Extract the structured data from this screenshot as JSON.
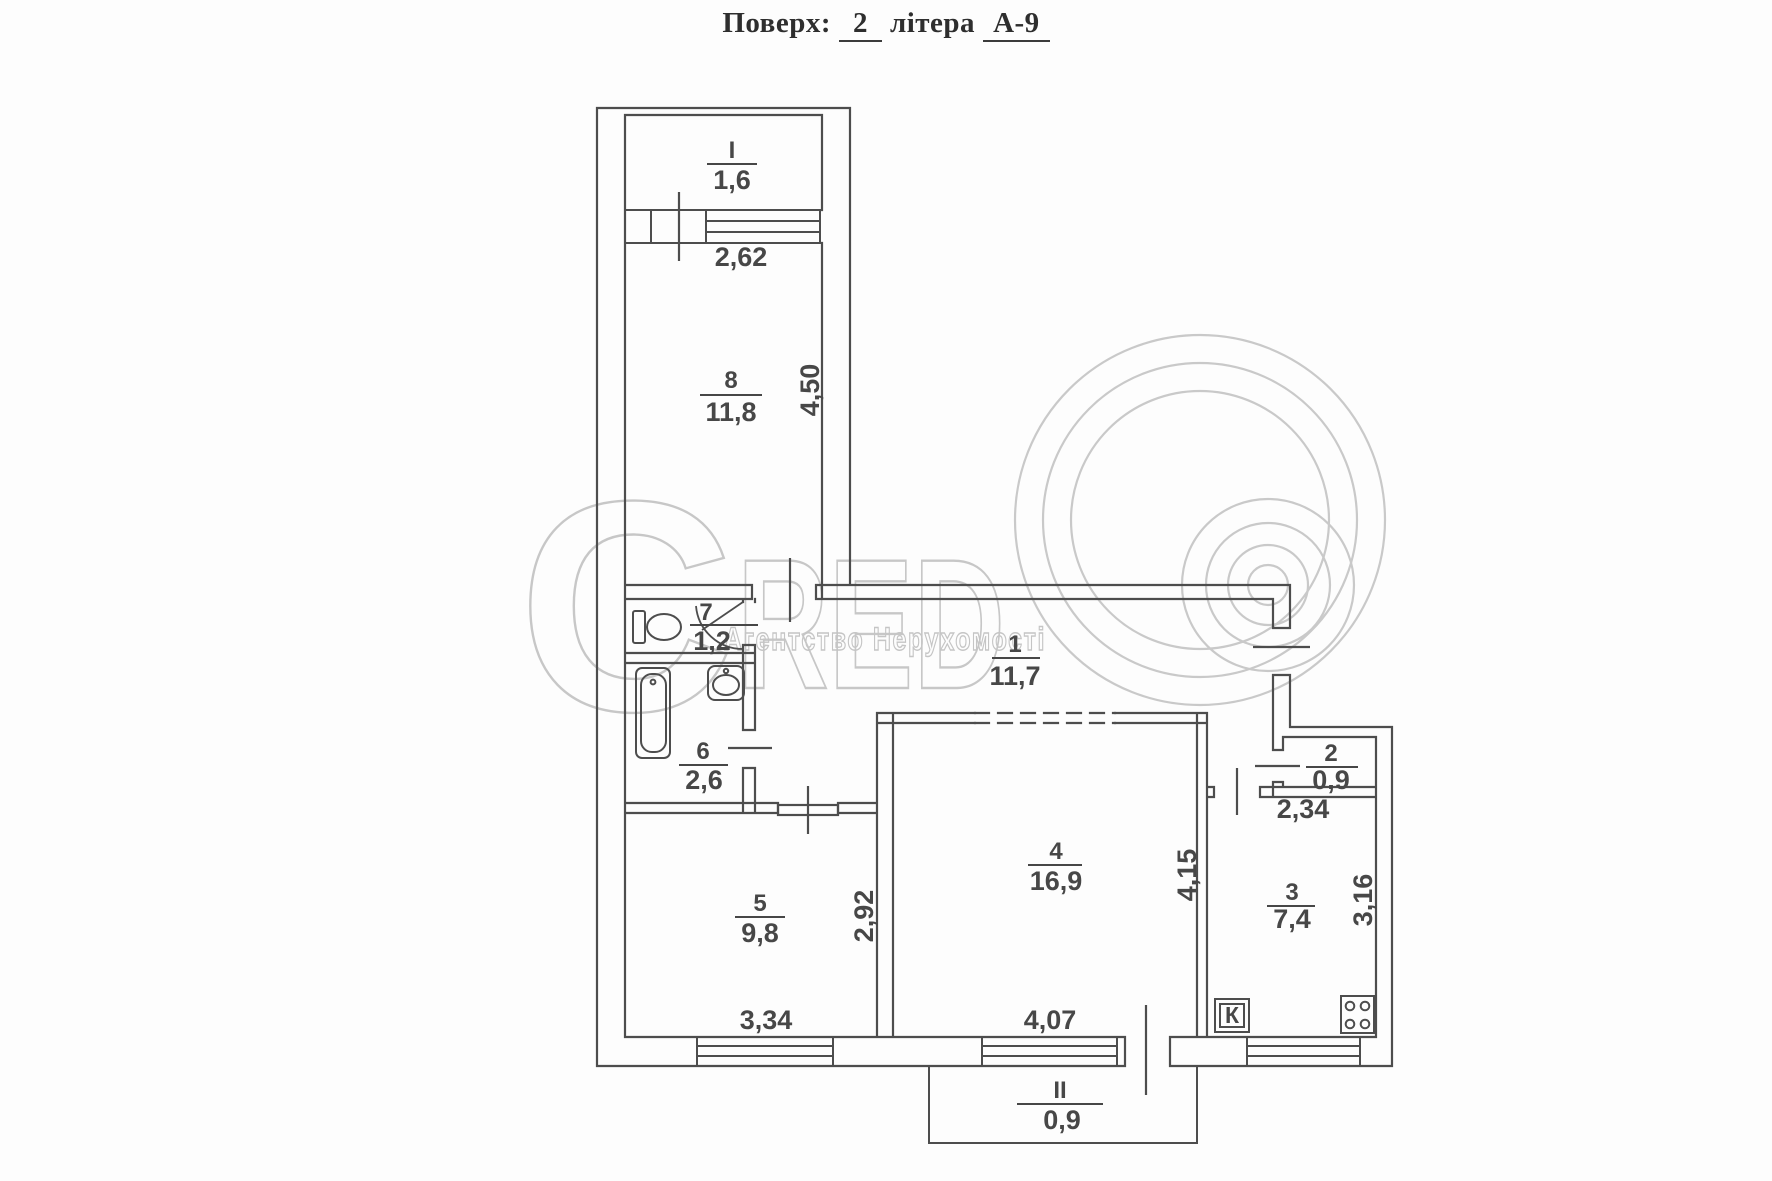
{
  "title": {
    "prefix": "Поверх:",
    "floor": "2",
    "middle": "літера",
    "building": "А-9"
  },
  "watermark": {
    "letter_c": "C",
    "letters_red": "RED",
    "subtitle": "Агентство Нерухомості"
  },
  "rooms": {
    "balcony_top": {
      "number": "I",
      "area": "1,6"
    },
    "room_8": {
      "number": "8",
      "area": "11,8"
    },
    "room_7": {
      "number": "7",
      "area": "1,2"
    },
    "room_1": {
      "number": "1",
      "area": "11,7"
    },
    "room_6": {
      "number": "6",
      "area": "2,6"
    },
    "room_2": {
      "number": "2",
      "area": "0,9"
    },
    "room_5": {
      "number": "5",
      "area": "9,8"
    },
    "room_4": {
      "number": "4",
      "area": "16,9"
    },
    "room_3": {
      "number": "3",
      "area": "7,4"
    },
    "balcony_bottom": {
      "number": "II",
      "area": "0,9"
    }
  },
  "dimensions": {
    "balcony_top_width": "2,62",
    "room_8_height": "4,50",
    "room_2_width": "2,34",
    "room_5_width": "3,34",
    "room_5_height": "2,92",
    "room_4_width": "4,07",
    "room_4_height": "4,15",
    "room_3_height": "3,16"
  },
  "markers": {
    "kitchen": "К"
  }
}
